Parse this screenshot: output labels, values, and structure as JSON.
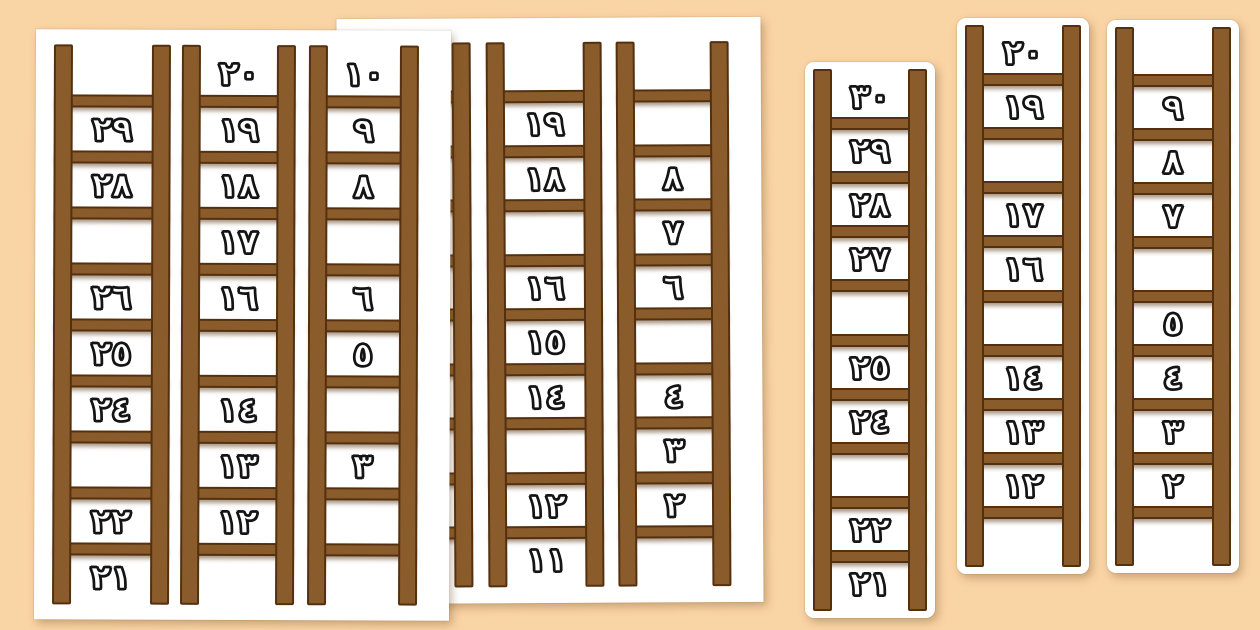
{
  "palette": {
    "background": "#f9d4a4",
    "page": "#ffffff",
    "wood": "#8a5c2b",
    "wood_dark": "#54300f",
    "digit_fill": "#ffffff",
    "digit_outline": "#141414"
  },
  "sheets": [
    {
      "name": "back-sheet",
      "description": "partially hidden worksheet page",
      "ladders": [
        {
          "slots": [
            null,
            null,
            null,
            null,
            null,
            null,
            null,
            null,
            null,
            null
          ]
        },
        {
          "slots": [
            null,
            "١٩",
            "١٨",
            null,
            "١٦",
            "١٥",
            "١٤",
            null,
            "١٢",
            "١١"
          ]
        },
        {
          "slots": [
            null,
            null,
            "٨",
            "٧",
            "٦",
            null,
            "٤",
            "٣",
            "٢",
            null
          ]
        }
      ]
    },
    {
      "name": "front-sheet",
      "description": "front worksheet page with three number ladders",
      "ladders": [
        {
          "slots": [
            null,
            "٢٩",
            "٢٨",
            null,
            "٢٦",
            "٢٥",
            "٢٤",
            null,
            "٢٢",
            "٢١"
          ]
        },
        {
          "slots": [
            "٢٠",
            "١٩",
            "١٨",
            "١٧",
            "١٦",
            null,
            "١٤",
            "١٣",
            "١٢",
            null
          ]
        },
        {
          "slots": [
            "١٠",
            "٩",
            "٨",
            null,
            "٦",
            "٥",
            null,
            "٣",
            null,
            null
          ]
        }
      ]
    },
    {
      "name": "strip-30-21",
      "description": "cut-out ladder strip 30 to 21",
      "ladders": [
        {
          "slots": [
            "٣٠",
            "٢٩",
            "٢٨",
            "٢٧",
            null,
            "٢٥",
            "٢٤",
            null,
            "٢٢",
            "٢١"
          ]
        }
      ]
    },
    {
      "name": "strip-20-11",
      "description": "cut-out ladder strip 20 to 11",
      "ladders": [
        {
          "slots": [
            "٢٠",
            "١٩",
            null,
            "١٧",
            "١٦",
            null,
            "١٤",
            "١٣",
            "١٢",
            null
          ]
        }
      ]
    },
    {
      "name": "strip-10-1",
      "description": "cut-out ladder strip 10 to 1",
      "ladders": [
        {
          "slots": [
            null,
            "٩",
            "٨",
            "٧",
            null,
            "٥",
            "٤",
            "٣",
            "٢",
            null
          ]
        }
      ]
    }
  ]
}
